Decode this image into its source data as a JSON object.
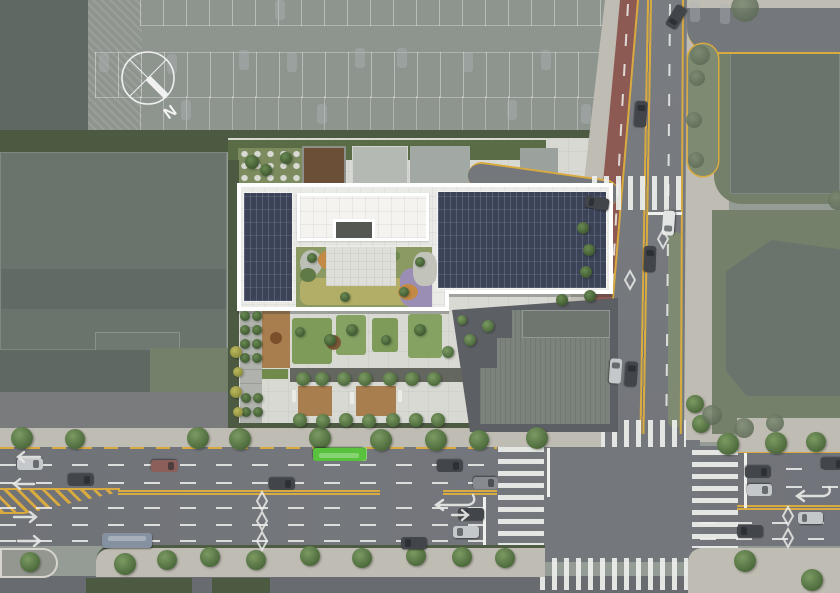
{
  "title": "Architectural site plan — aerial rendering",
  "compass": {
    "label": "N"
  },
  "palette": {
    "ctx-base": "#959c95",
    "parking": "#8e948e",
    "bldg-ctx": "#6a746d",
    "bldg-ctx-dark": "#5f6963",
    "hedge": "#4d5a42",
    "hedge-site": "#5a6c46",
    "grass-ctx": "#75806a",
    "site-paving": "#d8d9d3",
    "roof-border": "#ffffff",
    "roof-inner": "#eaebe6",
    "solar": "#3c4356",
    "penthouse": "#f4f3f0",
    "lawn": "#7e9b5a",
    "meadow": "#b2ae67",
    "lavender": "#9a8eb5",
    "orange": "#c28a44",
    "gravel": "#bcbfb7",
    "wood": "#a97e4e",
    "wood-dark": "#6b4f36",
    "shadow-band": "#64675f",
    "annex-ground": "#5c5f63",
    "annex-roof": "#7b837c",
    "annex-roof-dark": "#6e766f",
    "road": "#74777c",
    "road-dark": "#686b70",
    "sidewalk": "#bfbcb3",
    "island": "#94978f",
    "bike": "#8d5a53",
    "yellow": "#d9aa3f",
    "white-mark": "#eef0ed",
    "median-green": "#7e8a72",
    "bus-green": "#58c23c",
    "car-dark": "#42464b",
    "car-silver": "#c5c8ca",
    "car-white": "#e3e4e4",
    "car-gray": "#878b90",
    "car-red": "#8d5f5a",
    "car-lot": "#aeb3b6",
    "car-busg": "#58c23c",
    "car-busb": "#8591a0"
  },
  "scene": {
    "trees": [
      [
        22,
        438,
        11,
        1
      ],
      [
        75,
        439,
        10,
        1
      ],
      [
        198,
        438,
        11,
        1
      ],
      [
        240,
        439,
        11,
        1
      ],
      [
        320,
        438,
        11,
        1
      ],
      [
        381,
        440,
        11,
        1
      ],
      [
        436,
        440,
        11,
        1
      ],
      [
        479,
        440,
        10,
        1
      ],
      [
        537,
        438,
        11,
        1
      ],
      [
        728,
        444,
        11,
        1
      ],
      [
        776,
        443,
        11,
        1
      ],
      [
        816,
        442,
        10,
        1
      ],
      [
        30,
        562,
        10,
        1
      ],
      [
        125,
        564,
        11,
        1
      ],
      [
        167,
        560,
        10,
        1
      ],
      [
        210,
        557,
        10,
        1
      ],
      [
        256,
        560,
        10,
        1
      ],
      [
        310,
        556,
        10,
        1
      ],
      [
        362,
        558,
        10,
        1
      ],
      [
        416,
        556,
        10,
        1
      ],
      [
        462,
        557,
        10,
        1
      ],
      [
        505,
        558,
        10,
        1
      ],
      [
        745,
        561,
        11,
        1
      ],
      [
        812,
        580,
        11,
        1
      ],
      [
        695,
        404,
        9,
        1
      ],
      [
        701,
        424,
        9,
        1
      ],
      [
        745,
        8,
        14,
        3
      ],
      [
        700,
        55,
        10,
        3
      ],
      [
        697,
        78,
        8,
        3
      ],
      [
        694,
        120,
        8,
        3
      ],
      [
        696,
        160,
        8,
        3
      ],
      [
        712,
        415,
        10,
        3
      ],
      [
        744,
        428,
        10,
        3
      ],
      [
        775,
        423,
        9,
        3
      ],
      [
        838,
        200,
        10,
        3
      ],
      [
        303,
        379,
        7,
        1
      ],
      [
        322,
        379,
        7,
        1
      ],
      [
        344,
        379,
        7,
        1
      ],
      [
        365,
        379,
        7,
        1
      ],
      [
        390,
        379,
        7,
        1
      ],
      [
        412,
        379,
        7,
        1
      ],
      [
        434,
        379,
        7,
        1
      ],
      [
        300,
        420,
        7,
        1
      ],
      [
        323,
        421,
        7,
        1
      ],
      [
        346,
        420,
        7,
        1
      ],
      [
        369,
        421,
        7,
        1
      ],
      [
        393,
        420,
        7,
        1
      ],
      [
        416,
        420,
        7,
        1
      ],
      [
        438,
        420,
        7,
        1
      ],
      [
        330,
        340,
        6,
        2
      ],
      [
        352,
        330,
        6,
        2
      ],
      [
        420,
        330,
        6,
        2
      ],
      [
        300,
        332,
        5,
        2
      ],
      [
        386,
        340,
        5,
        2
      ],
      [
        448,
        352,
        6,
        1
      ],
      [
        470,
        340,
        6,
        1
      ],
      [
        488,
        326,
        6,
        1
      ],
      [
        462,
        320,
        5,
        1
      ],
      [
        245,
        316,
        5,
        2
      ],
      [
        257,
        316,
        5,
        2
      ],
      [
        245,
        330,
        5,
        2
      ],
      [
        257,
        330,
        5,
        2
      ],
      [
        245,
        344,
        5,
        2
      ],
      [
        257,
        344,
        5,
        2
      ],
      [
        245,
        358,
        5,
        2
      ],
      [
        257,
        358,
        5,
        2
      ],
      [
        246,
        398,
        5,
        2
      ],
      [
        258,
        398,
        5,
        2
      ],
      [
        246,
        412,
        5,
        2
      ],
      [
        258,
        412,
        5,
        2
      ],
      [
        236,
        352,
        6,
        4
      ],
      [
        238,
        372,
        5,
        4
      ],
      [
        236,
        392,
        6,
        4
      ],
      [
        238,
        412,
        5,
        4
      ],
      [
        252,
        162,
        7,
        2
      ],
      [
        266,
        170,
        6,
        2
      ],
      [
        286,
        158,
        6,
        2
      ],
      [
        583,
        228,
        6,
        2
      ],
      [
        589,
        250,
        6,
        2
      ],
      [
        586,
        272,
        6,
        2
      ],
      [
        562,
        300,
        6,
        2
      ],
      [
        590,
        296,
        6,
        2
      ],
      [
        312,
        258,
        5,
        2
      ],
      [
        345,
        297,
        5,
        2
      ],
      [
        420,
        262,
        5,
        2
      ],
      [
        404,
        292,
        5,
        2
      ]
    ],
    "cars": [
      [
        104,
        62,
        90,
        "lot",
        20,
        10
      ],
      [
        172,
        64,
        90,
        "lot",
        20,
        10
      ],
      [
        244,
        60,
        90,
        "lot",
        20,
        10
      ],
      [
        292,
        62,
        90,
        "lot",
        20,
        10
      ],
      [
        360,
        58,
        90,
        "lot",
        20,
        10
      ],
      [
        402,
        58,
        90,
        "lot",
        20,
        10
      ],
      [
        468,
        62,
        90,
        "lot",
        20,
        10
      ],
      [
        546,
        60,
        90,
        "lot",
        20,
        10
      ],
      [
        186,
        110,
        90,
        "lot",
        20,
        10
      ],
      [
        322,
        114,
        90,
        "lot",
        20,
        10
      ],
      [
        512,
        110,
        90,
        "lot",
        20,
        10
      ],
      [
        586,
        114,
        90,
        "lot",
        20,
        10
      ],
      [
        280,
        10,
        90,
        "lot",
        20,
        10
      ],
      [
        695,
        12,
        90,
        "lot",
        20,
        10
      ],
      [
        725,
        14,
        90,
        "lot",
        20,
        10
      ],
      [
        641,
        114,
        94,
        "dark",
        26,
        12
      ],
      [
        650,
        259,
        92,
        "dark",
        26,
        12
      ],
      [
        615,
        371,
        94,
        "silver",
        25,
        12
      ],
      [
        631,
        374,
        94,
        "dark",
        25,
        12
      ],
      [
        668,
        223,
        -86,
        "white",
        25,
        12
      ],
      [
        676,
        17,
        -58,
        "dark",
        24,
        12
      ],
      [
        597,
        203,
        10,
        "dark",
        24,
        12
      ],
      [
        30,
        464,
        180,
        "silver",
        26,
        12
      ],
      [
        81,
        480,
        180,
        "dark",
        26,
        12
      ],
      [
        164,
        466,
        180,
        "red",
        27,
        12
      ],
      [
        282,
        484,
        180,
        "dark",
        26,
        12
      ],
      [
        450,
        466,
        180,
        "dark",
        26,
        12
      ],
      [
        485,
        483,
        180,
        "gray",
        25,
        12
      ],
      [
        471,
        514,
        0,
        "dark",
        26,
        12
      ],
      [
        466,
        532,
        0,
        "silver",
        26,
        12
      ],
      [
        414,
        543,
        0,
        "dark",
        26,
        12
      ],
      [
        758,
        472,
        180,
        "dark",
        26,
        12
      ],
      [
        759,
        490,
        180,
        "silver",
        25,
        12
      ],
      [
        833,
        464,
        180,
        "dark",
        24,
        12
      ],
      [
        810,
        518,
        0,
        "silver",
        25,
        12
      ],
      [
        750,
        531,
        0,
        "dark",
        26,
        12
      ],
      [
        339,
        454,
        180,
        "busg",
        52,
        13
      ],
      [
        127,
        540,
        0,
        "busb",
        50,
        15
      ]
    ]
  }
}
